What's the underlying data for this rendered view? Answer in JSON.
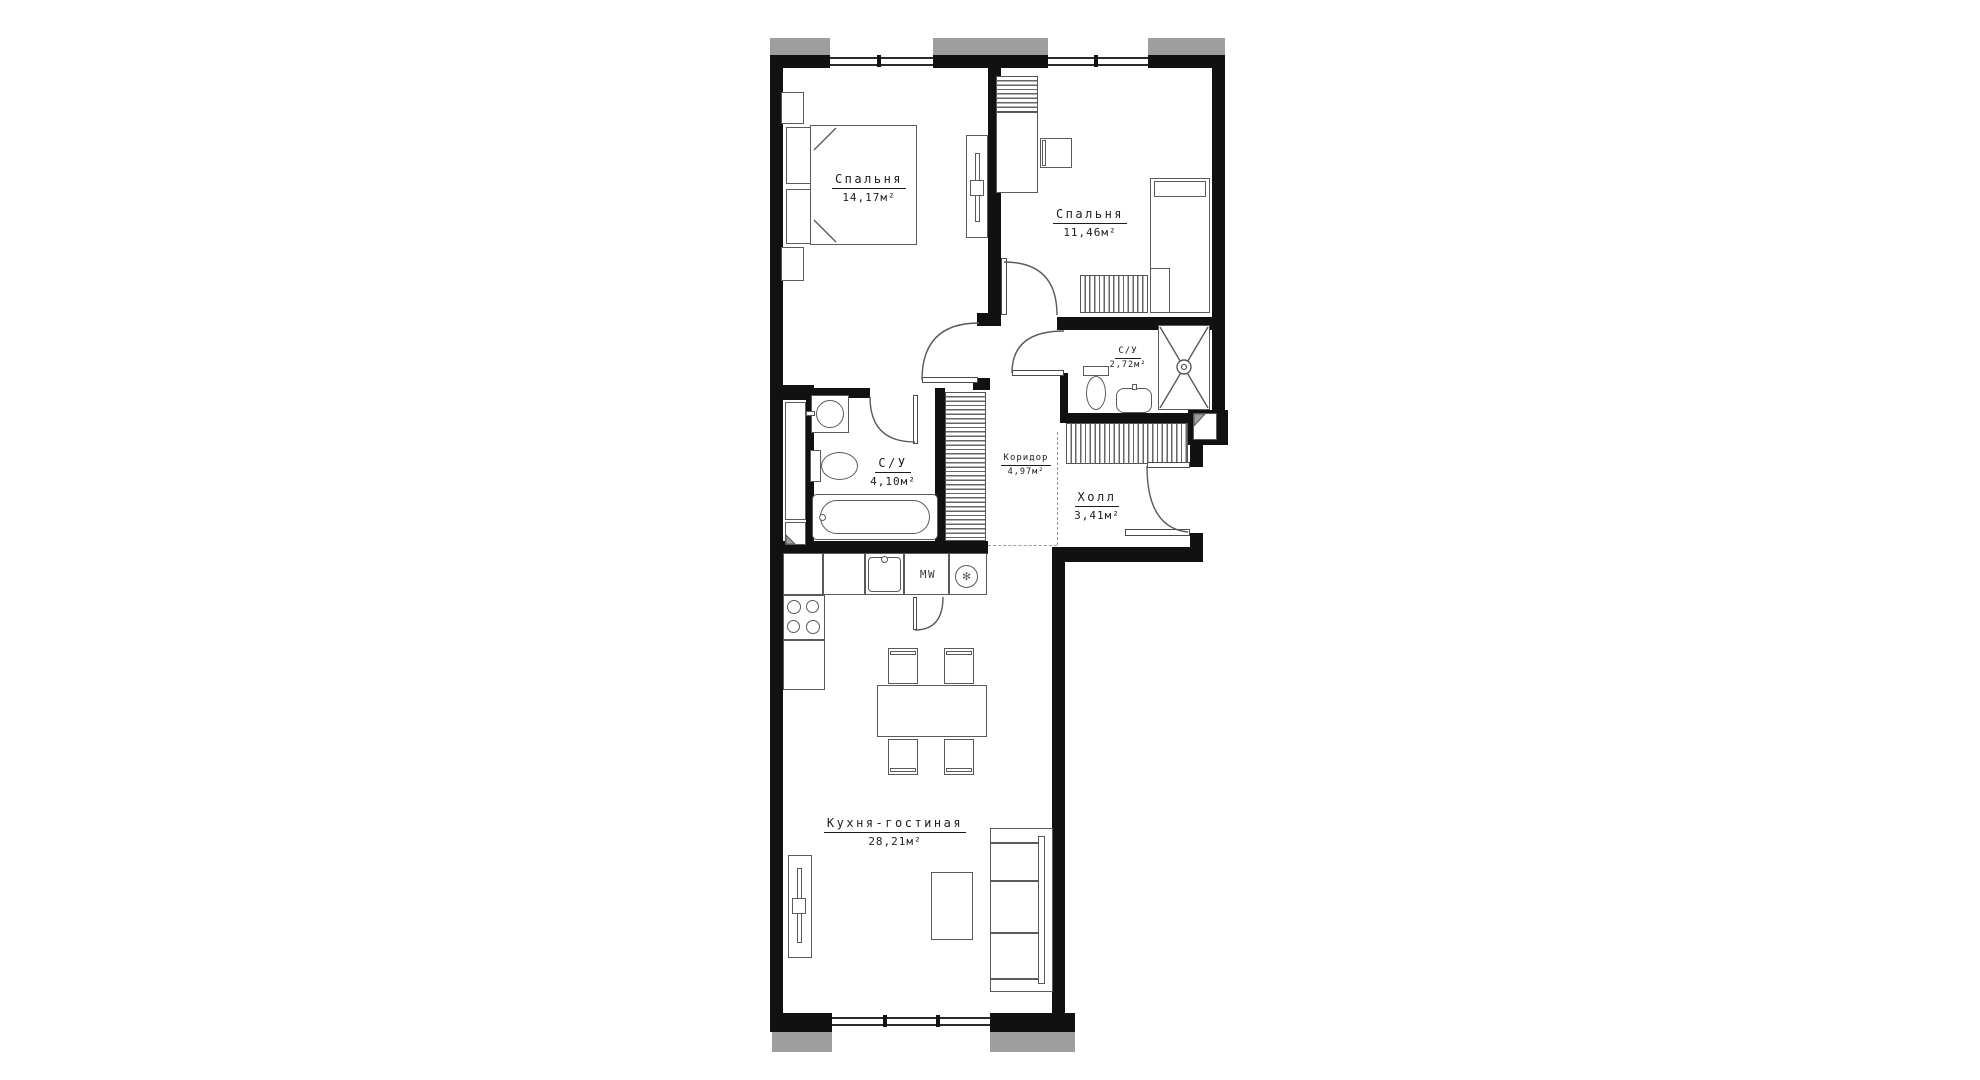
{
  "plan_title": "apartment-floor-plan",
  "colors": {
    "wall": "#111111",
    "exterior": "#9e9e9e",
    "furniture_line": "#5a5a5a",
    "background": "#ffffff"
  },
  "rooms": [
    {
      "id": "bedroom-1",
      "name": "Спальня",
      "area": "14,17м²"
    },
    {
      "id": "bedroom-2",
      "name": "Спальня",
      "area": "11,46м²"
    },
    {
      "id": "bathroom-small",
      "name": "С/У",
      "area": "2,72м²"
    },
    {
      "id": "hall",
      "name": "Холл",
      "area": "3,41м²"
    },
    {
      "id": "bathroom-big",
      "name": "С/У",
      "area": "4,10м²"
    },
    {
      "id": "corridor",
      "name": "Коридор",
      "area": "4,97м²"
    },
    {
      "id": "kitchen-living",
      "name": "Кухня-гостиная",
      "area": "28,21м²"
    }
  ],
  "appliances": {
    "microwave": "MW"
  }
}
